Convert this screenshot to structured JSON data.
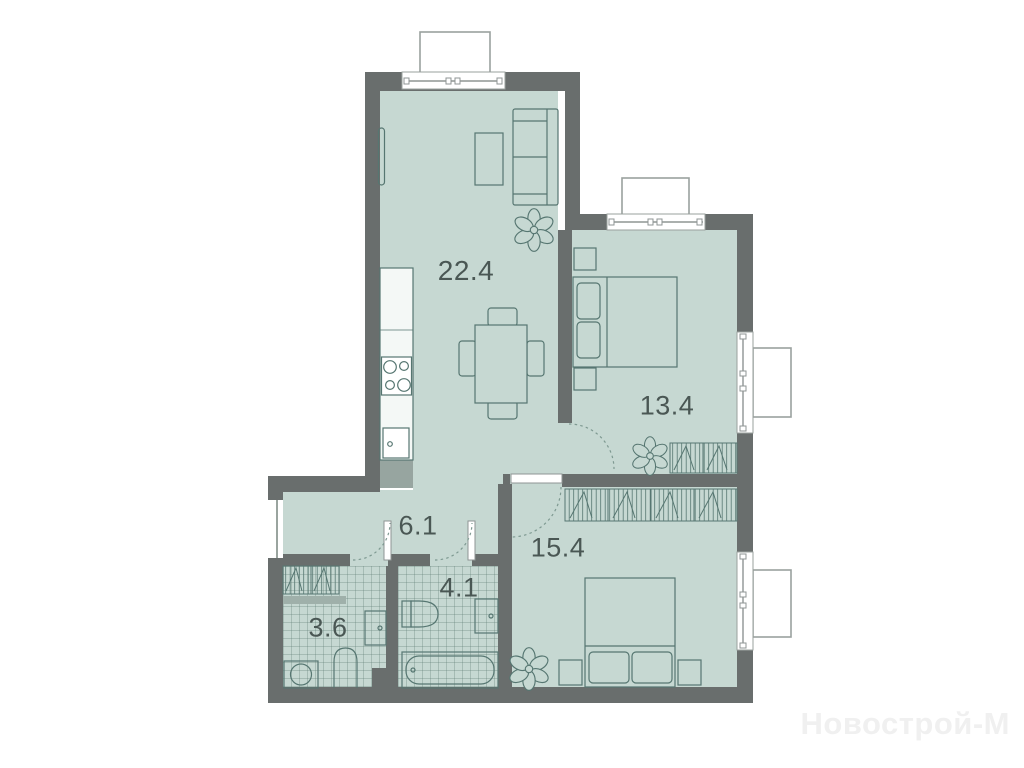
{
  "plan": {
    "type": "apartment-floor-plan",
    "rooms": [
      {
        "key": "living_kitchen",
        "area_label": "22.4",
        "furniture": [
          "sofa",
          "tv",
          "tv-stand",
          "dining-table",
          "chairs",
          "kitchen-counter",
          "stove",
          "kitchen-sink",
          "plant"
        ]
      },
      {
        "key": "bedroom_main",
        "area_label": "13.4",
        "furniture": [
          "double-bed",
          "nightstands",
          "wardrobe",
          "plant",
          "window",
          "balcony"
        ]
      },
      {
        "key": "hallway",
        "area_label": "6.1",
        "furniture": [
          "entrance-door",
          "door-arcs"
        ]
      },
      {
        "key": "bedroom_second",
        "area_label": "15.4",
        "furniture": [
          "double-bed",
          "nightstands",
          "wardrobe",
          "plant",
          "window"
        ]
      },
      {
        "key": "bathroom",
        "area_label": "4.1",
        "furniture": [
          "bathtub",
          "toilet",
          "sink"
        ]
      },
      {
        "key": "wc_laundry",
        "area_label": "3.6",
        "furniture": [
          "washing-machine",
          "toilet",
          "sink",
          "wardrobe"
        ]
      }
    ],
    "watermark": {
      "text": "Новострой-М"
    },
    "colors": {
      "wall": "#696e6d",
      "floor": "#c6d8d2",
      "furniture_line": "#567671",
      "tile_line": "#5a7870",
      "window_frame": "#9aa19e",
      "label_text": "#4a5754",
      "watermark_text": "#f0f0f0"
    }
  }
}
